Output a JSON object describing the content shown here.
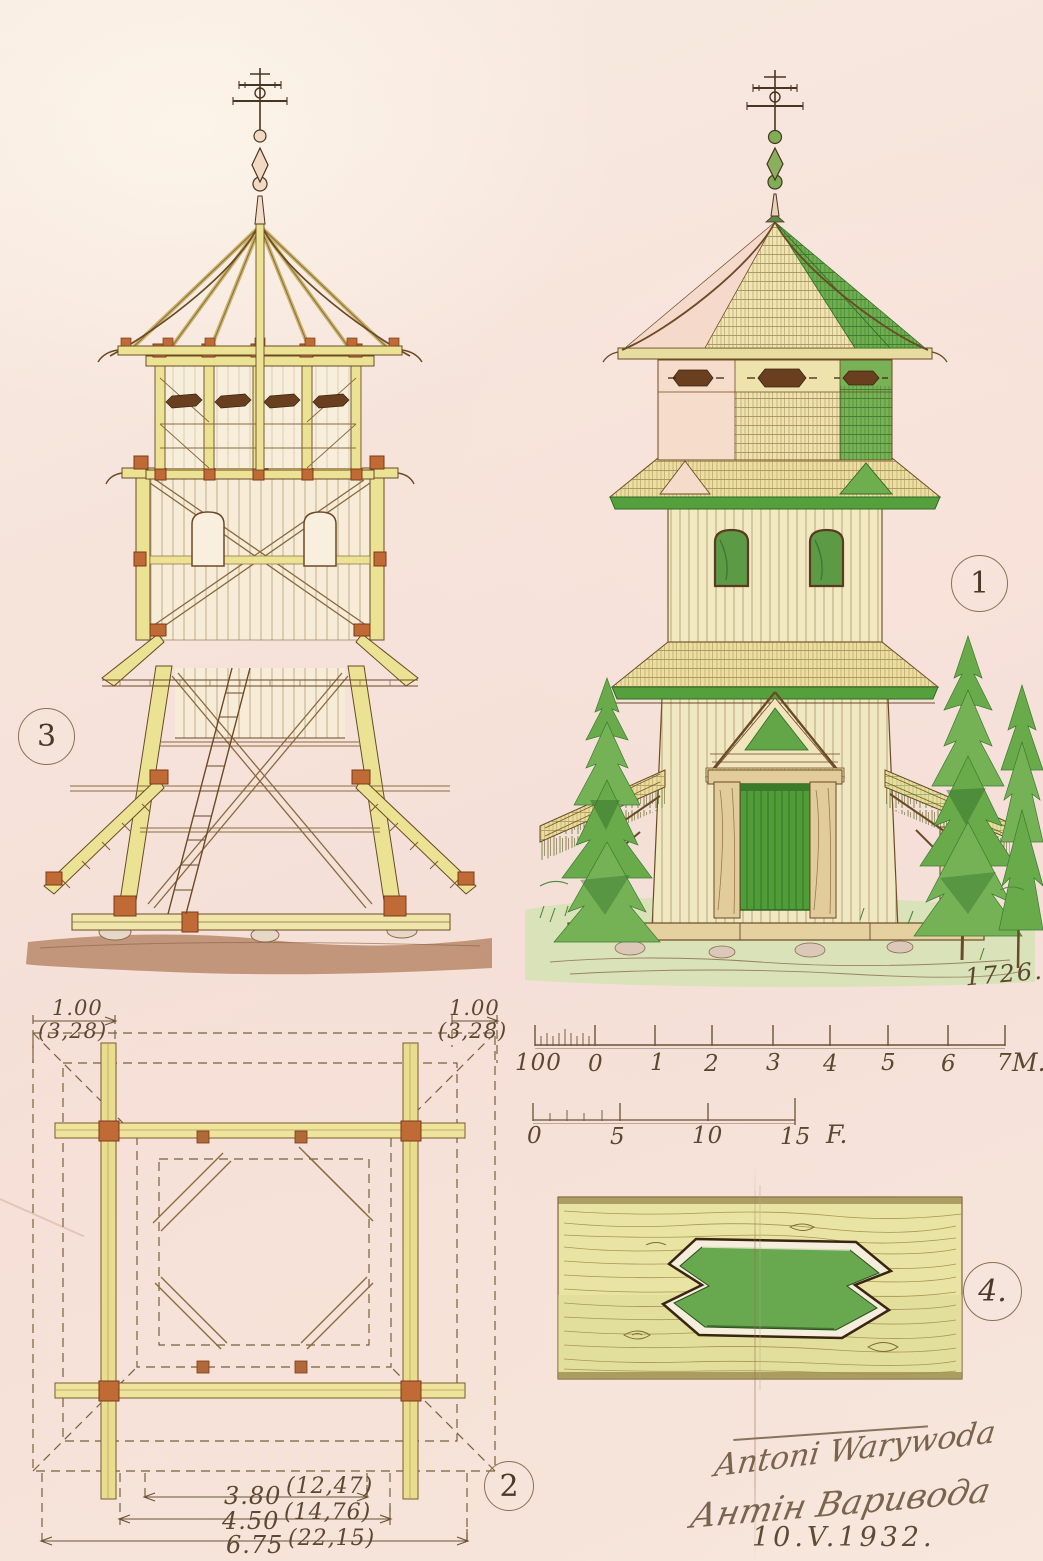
{
  "figures": {
    "section": {
      "number": "3"
    },
    "elevation": {
      "number": "1",
      "year": "1726."
    },
    "plan": {
      "number": "2",
      "dim_top_left": {
        "value": "1.00",
        "feet": "(3,28)"
      },
      "dim_top_right": {
        "value": "1.00",
        "feet": "(3,28)"
      },
      "dims_bottom": [
        {
          "value": "3.80",
          "feet": "(12,47)"
        },
        {
          "value": "4.50",
          "feet": "(14,76)"
        },
        {
          "value": "6.75",
          "feet": "(22,15)"
        }
      ]
    },
    "joint_detail": {
      "number": "4."
    }
  },
  "scales": {
    "meters": {
      "ticks": [
        "100",
        "0",
        "1",
        "2",
        "3",
        "4",
        "5",
        "6",
        "7"
      ],
      "unit": "M."
    },
    "feet": {
      "ticks": [
        "0",
        "5",
        "10",
        "15"
      ],
      "unit": "F."
    }
  },
  "signatures": {
    "line1": "Antoni Warywoda",
    "line2": "Антін Варивода",
    "date": "10.V.1932."
  },
  "palette": {
    "paper": "#f6e3da",
    "ink": "#5d4730",
    "timber_yellow": "#ece294",
    "joint_orange": "#c06a36",
    "foliage_green": "#69aa4a",
    "roof_green": "#55a03c",
    "roof_pink": "#f5d9ca",
    "shingle_cream": "#ece0a2",
    "ground_brown": "#b9886a",
    "joint_detail_green": "#68a84e"
  }
}
